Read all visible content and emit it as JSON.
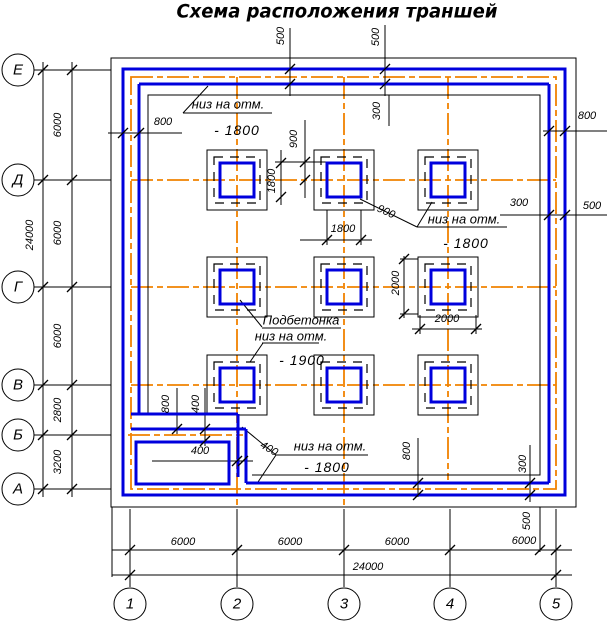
{
  "title": "Схема расположения траншей",
  "colors": {
    "trench_blue": "#0000dd",
    "axis_orange": "#f08200",
    "line_black": "#000000"
  },
  "axis_rows": [
    {
      "label": "Е",
      "x": 18,
      "y": 70
    },
    {
      "label": "Д",
      "x": 18,
      "y": 180
    },
    {
      "label": "Г",
      "x": 18,
      "y": 287
    },
    {
      "label": "В",
      "x": 18,
      "y": 385
    },
    {
      "label": "Б",
      "x": 18,
      "y": 435
    },
    {
      "label": "А",
      "x": 18,
      "y": 489
    }
  ],
  "axis_cols": [
    {
      "label": "1",
      "x": 130,
      "y": 604
    },
    {
      "label": "2",
      "x": 237,
      "y": 604
    },
    {
      "label": "3",
      "x": 344,
      "y": 604
    },
    {
      "label": "4",
      "x": 450,
      "y": 604
    },
    {
      "label": "5",
      "x": 556,
      "y": 604
    }
  ],
  "labels": [
    {
      "text": "500",
      "x": 281,
      "y": 36,
      "rot": -90,
      "kind": "dim"
    },
    {
      "text": "500",
      "x": 376,
      "y": 37,
      "rot": -90,
      "kind": "dim"
    },
    {
      "text": "800",
      "x": 163,
      "y": 122,
      "kind": "dim"
    },
    {
      "text": "800",
      "x": 587,
      "y": 116,
      "kind": "dim"
    },
    {
      "text": "300",
      "x": 377,
      "y": 111,
      "rot": -90,
      "kind": "dim"
    },
    {
      "text": "900",
      "x": 294,
      "y": 139,
      "rot": -90,
      "kind": "dim"
    },
    {
      "text": "1800",
      "x": 272,
      "y": 181,
      "rot": -90,
      "kind": "dim"
    },
    {
      "text": "300",
      "x": 519,
      "y": 203,
      "kind": "dim"
    },
    {
      "text": "500",
      "x": 592,
      "y": 206,
      "kind": "dim"
    },
    {
      "text": "900",
      "x": 386,
      "y": 212,
      "rot": 25,
      "kind": "dim"
    },
    {
      "text": "1800",
      "x": 343,
      "y": 229,
      "kind": "dim"
    },
    {
      "text": "2000",
      "x": 396,
      "y": 283,
      "rot": -90,
      "kind": "dim"
    },
    {
      "text": "2000",
      "x": 447,
      "y": 319,
      "kind": "dim"
    },
    {
      "text": "800",
      "x": 166,
      "y": 404,
      "rot": -90,
      "kind": "dim"
    },
    {
      "text": "400",
      "x": 196,
      "y": 404,
      "rot": -90,
      "kind": "dim"
    },
    {
      "text": "400",
      "x": 200,
      "y": 451,
      "kind": "dim"
    },
    {
      "text": "400",
      "x": 269,
      "y": 449,
      "rot": 30,
      "kind": "dim"
    },
    {
      "text": "800",
      "x": 407,
      "y": 451,
      "rot": -90,
      "kind": "dim"
    },
    {
      "text": "300",
      "x": 523,
      "y": 464,
      "rot": -90,
      "kind": "dim"
    },
    {
      "text": "6000",
      "x": 58,
      "y": 125,
      "rot": -90,
      "kind": "dim"
    },
    {
      "text": "6000",
      "x": 58,
      "y": 233,
      "rot": -90,
      "kind": "dim"
    },
    {
      "text": "6000",
      "x": 58,
      "y": 336,
      "rot": -90,
      "kind": "dim"
    },
    {
      "text": "2800",
      "x": 58,
      "y": 410,
      "rot": -90,
      "kind": "dim"
    },
    {
      "text": "3200",
      "x": 58,
      "y": 462,
      "rot": -90,
      "kind": "dim"
    },
    {
      "text": "24000",
      "x": 30,
      "y": 235,
      "rot": -90,
      "kind": "dim"
    },
    {
      "text": "6000",
      "x": 183,
      "y": 542,
      "kind": "dim"
    },
    {
      "text": "6000",
      "x": 290,
      "y": 542,
      "kind": "dim"
    },
    {
      "text": "6000",
      "x": 397,
      "y": 542,
      "kind": "dim"
    },
    {
      "text": "6000",
      "x": 524,
      "y": 541,
      "kind": "dim"
    },
    {
      "text": "500",
      "x": 527,
      "y": 521,
      "rot": -90,
      "kind": "dim"
    },
    {
      "text": "24000",
      "x": 368,
      "y": 567,
      "kind": "dim"
    },
    {
      "text": "низ на отм.",
      "x": 228,
      "y": 104,
      "kind": "ann"
    },
    {
      "text": "- 1800",
      "x": 237,
      "y": 130,
      "kind": "elev"
    },
    {
      "text": "низ на отм.",
      "x": 464,
      "y": 219,
      "kind": "ann"
    },
    {
      "text": "- 1800",
      "x": 466,
      "y": 243,
      "kind": "elev"
    },
    {
      "text": "Подбетонка",
      "x": 301,
      "y": 320,
      "kind": "ann"
    },
    {
      "text": "низ на отм.",
      "x": 291,
      "y": 336,
      "kind": "ann"
    },
    {
      "text": "- 1900",
      "x": 302,
      "y": 360,
      "kind": "elev"
    },
    {
      "text": "низ на отм.",
      "x": 330,
      "y": 446,
      "kind": "ann"
    },
    {
      "text": "- 1800",
      "x": 327,
      "y": 467,
      "kind": "elev"
    }
  ]
}
